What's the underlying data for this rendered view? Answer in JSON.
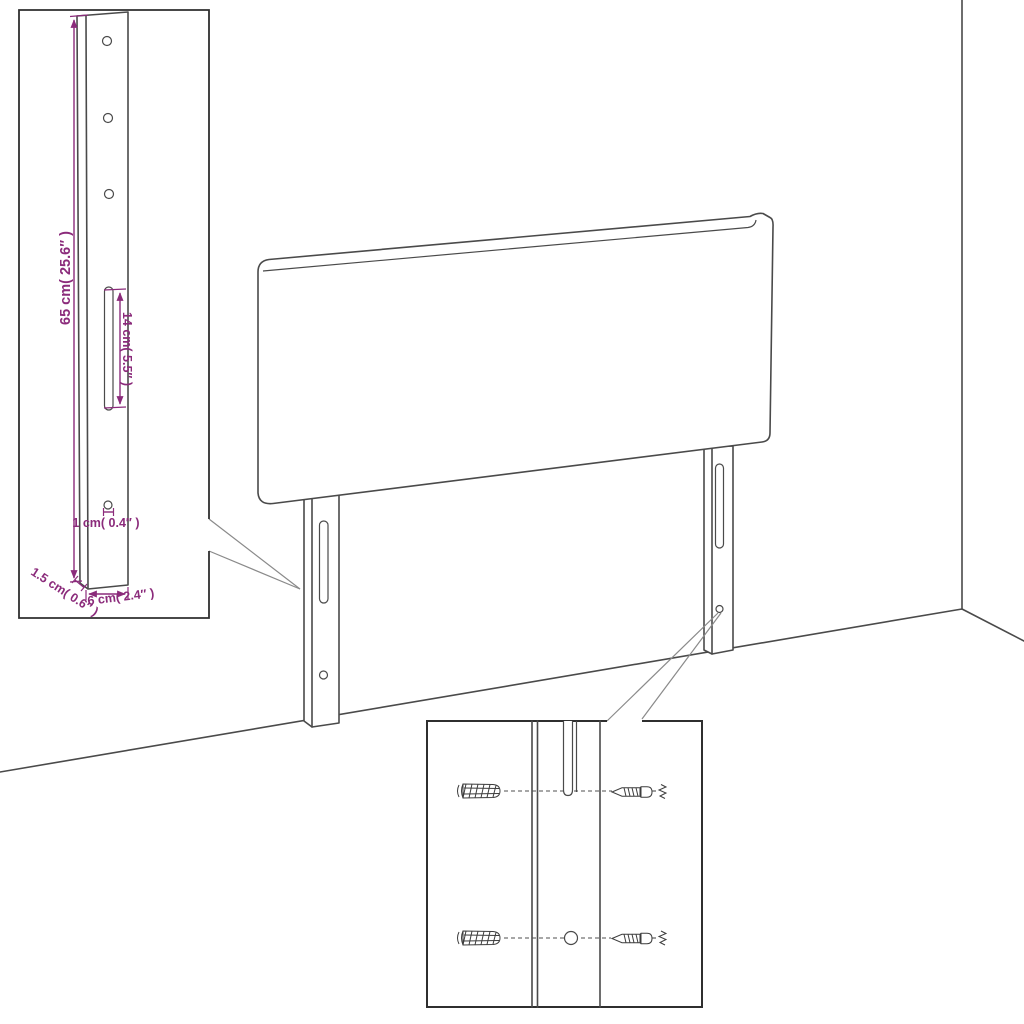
{
  "title": "Headboard mounting dimension diagram",
  "colors": {
    "line": "#4a4a4a",
    "box_border": "#2f2f2f",
    "dimension": "#8b2b7b",
    "background": "#ffffff",
    "callout": "#8a8a8a"
  },
  "leg_detail": {
    "height_label": "65 cm( 25.6″ )",
    "slot_label": "14 cm( 5.5″ )",
    "hole_label": "1 cm( 0.4″ )",
    "thickness_label": "1.5 cm( 0.6″ )",
    "width_label": "6 cm( 2.4″ )"
  }
}
